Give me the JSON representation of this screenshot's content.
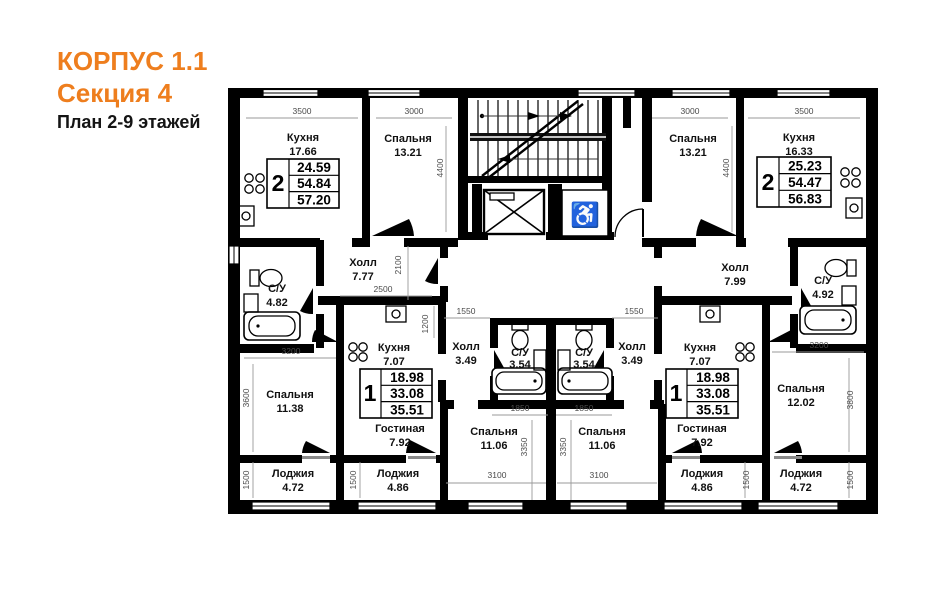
{
  "header": {
    "building": "КОРПУС 1.1",
    "section": "Секция 4",
    "plan": "План 2-9 этажей"
  },
  "colors": {
    "accent": "#EE7E1E",
    "walls": "#000000",
    "dim_text": "#4a4a4a"
  },
  "icons": {
    "wheelchair": "♿"
  },
  "apartments": [
    {
      "id": "2k-left",
      "rooms": [
        {
          "name": "Кухня",
          "area": "17.66"
        },
        {
          "name": "Спальня",
          "area": "13.21"
        },
        {
          "name": "Холл",
          "area": "7.77"
        },
        {
          "name": "С/У",
          "area": "4.82"
        },
        {
          "name": "Спальня",
          "area": "11.38"
        },
        {
          "name": "Лоджия",
          "area": "4.72"
        }
      ],
      "summary": {
        "rooms": "2",
        "row1": "24.59",
        "row2": "54.84",
        "row3": "57.20"
      }
    },
    {
      "id": "2k-right",
      "rooms": [
        {
          "name": "Спальня",
          "area": "13.21"
        },
        {
          "name": "Кухня",
          "area": "16.33"
        },
        {
          "name": "Холл",
          "area": "7.99"
        },
        {
          "name": "С/У",
          "area": "4.92"
        },
        {
          "name": "Спальня",
          "area": "12.02"
        },
        {
          "name": "Лоджия",
          "area": "4.72"
        }
      ],
      "summary": {
        "rooms": "2",
        "row1": "25.23",
        "row2": "54.47",
        "row3": "56.83"
      }
    },
    {
      "id": "1k-left",
      "rooms": [
        {
          "name": "Кухня",
          "area": "7.07"
        },
        {
          "name": "Холл",
          "area": "3.49"
        },
        {
          "name": "С/У",
          "area": "3.54"
        },
        {
          "name": "Спальня",
          "area": "11.06"
        },
        {
          "name": "Гостиная",
          "area": "7.92"
        },
        {
          "name": "Лоджия",
          "area": "4.86"
        }
      ],
      "summary": {
        "rooms": "1",
        "row1": "18.98",
        "row2": "33.08",
        "row3": "35.51"
      }
    },
    {
      "id": "1k-right",
      "rooms": [
        {
          "name": "Кухня",
          "area": "7.07"
        },
        {
          "name": "Холл",
          "area": "3.49"
        },
        {
          "name": "С/У",
          "area": "3.54"
        },
        {
          "name": "Спальня",
          "area": "11.06"
        },
        {
          "name": "Гостиная",
          "area": "7.92"
        },
        {
          "name": "Лоджия",
          "area": "4.86"
        }
      ],
      "summary": {
        "rooms": "1",
        "row1": "18.98",
        "row2": "33.08",
        "row3": "35.51"
      }
    }
  ],
  "dims": [
    "3500",
    "3000",
    "3000",
    "3500",
    "4400",
    "4400",
    "2100",
    "2500",
    "1200",
    "1550",
    "1550",
    "1850",
    "1850",
    "3350",
    "3350",
    "3100",
    "3100",
    "3200",
    "3600",
    "1500",
    "1500",
    "3200",
    "3800",
    "1500",
    "1500"
  ]
}
